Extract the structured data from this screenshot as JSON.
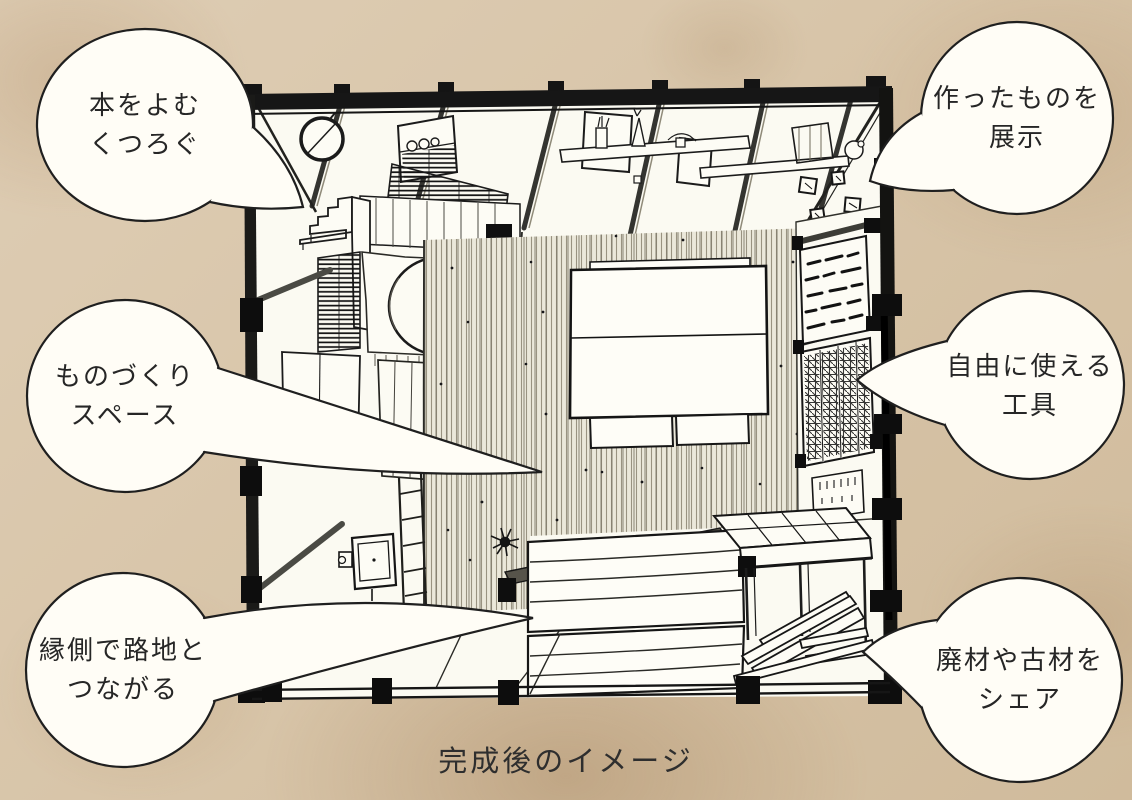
{
  "caption": "完成後のイメージ",
  "bubbles": [
    {
      "id": "reading-relax",
      "line1": "本をよむ",
      "line2": "くつろぐ"
    },
    {
      "id": "making-space",
      "line1": "ものづくり",
      "line2": "スペース"
    },
    {
      "id": "engawa-alley",
      "line1": "縁側で路地と",
      "line2": "つながる"
    },
    {
      "id": "display-works",
      "line1": "作ったものを",
      "line2": "展示"
    },
    {
      "id": "free-tools",
      "line1": "自由に使える",
      "line2": "工具"
    },
    {
      "id": "share-material",
      "line1": "廃材や古材を",
      "line2": "シェア"
    }
  ],
  "colors": {
    "paper": "#d8c5a9",
    "ink": "#1c1c1c",
    "bubble_fill": "#fffdf6"
  }
}
